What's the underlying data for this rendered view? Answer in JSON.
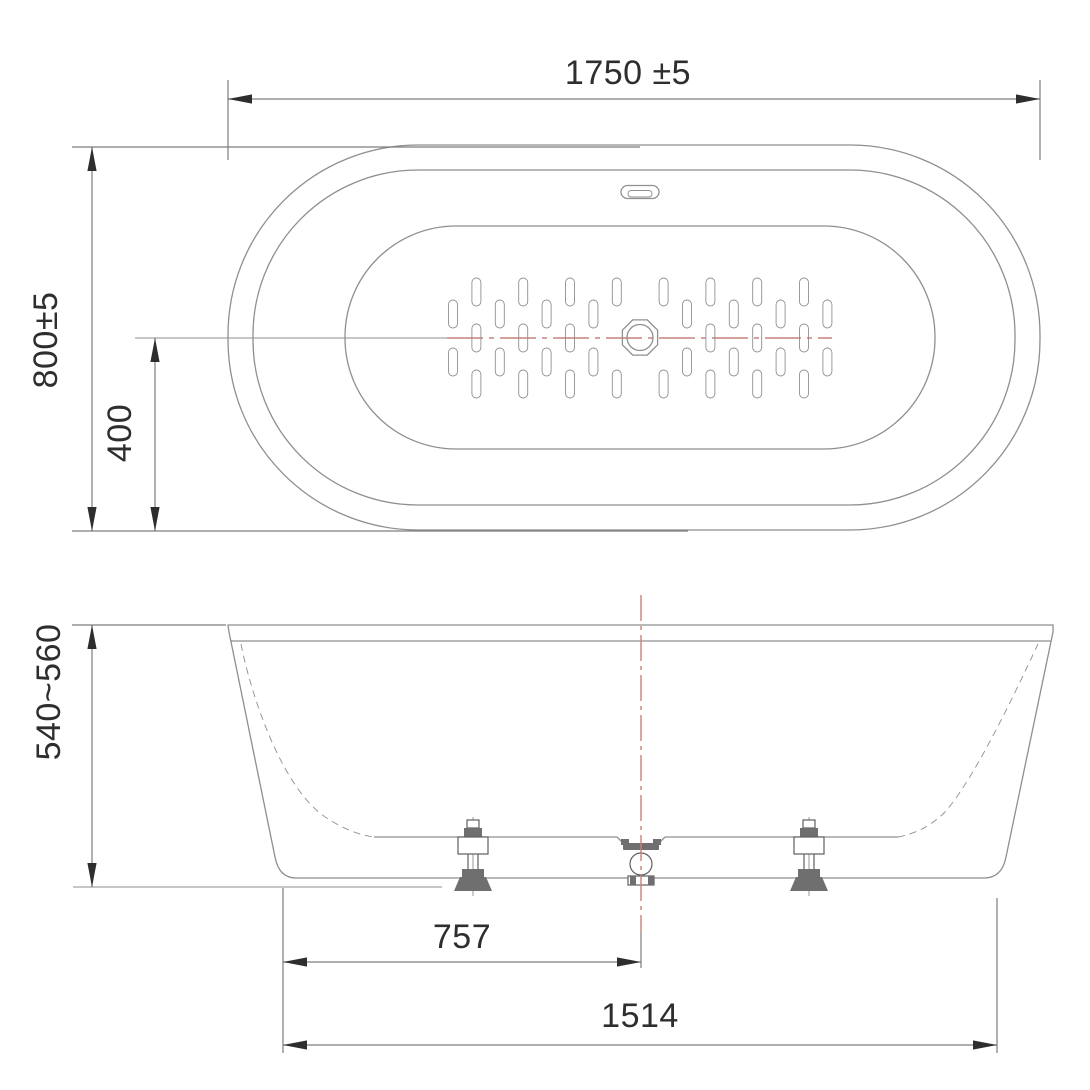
{
  "dimensions": {
    "plan_width": "1750 ±5",
    "plan_depth": "800±5",
    "plan_center_offset": "400",
    "side_height": "540~560",
    "drain_from_edge": "757",
    "base_width": "1514"
  },
  "colors": {
    "background": "#ffffff",
    "line": "#8f8f8f",
    "dimension": "#2e2e2e",
    "centerline_red": "#c9807a"
  }
}
